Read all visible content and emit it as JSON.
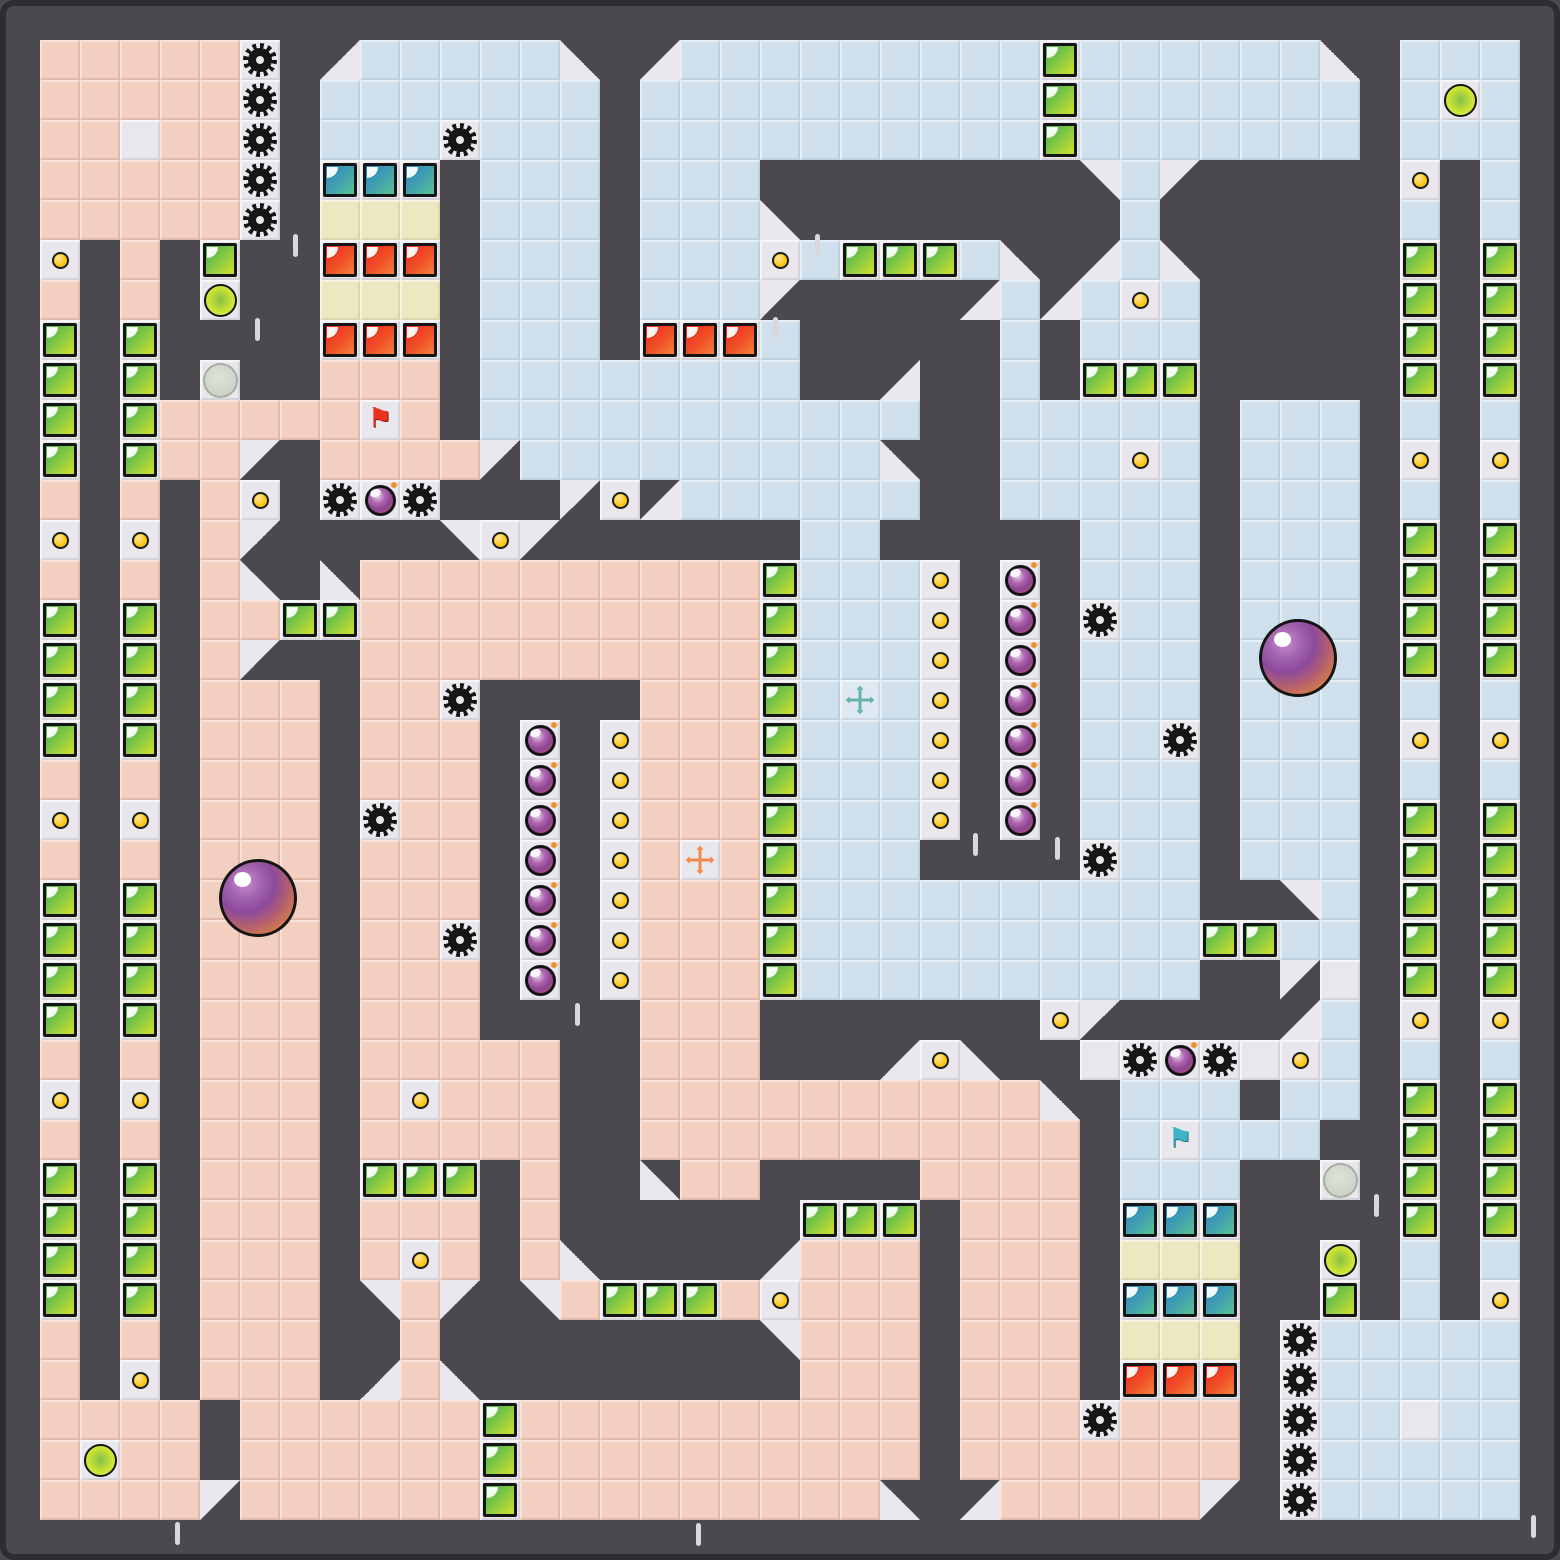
{
  "board": {
    "cols": 37,
    "rows": 37,
    "tile_px": 40,
    "offset_px": 40,
    "width_px": 1560,
    "height_px": 1560
  },
  "palette": {
    "wall": "#4b484e",
    "wall_edge": "#2e2c31",
    "floor_pink": "#f2cfc0",
    "floor_blue": "#cfe0ec",
    "tile_white": "#e9e7ec",
    "tile_cream": "#ece9c2",
    "box_green": [
      "#3fae4e",
      "#cfe22e"
    ],
    "box_red": [
      "#ee2020",
      "#f4823a"
    ],
    "box_cyan": [
      "#2b84c8",
      "#57c291"
    ],
    "coin": "#fcca1c",
    "gear": "#161616",
    "bomb": [
      "#b06ab4",
      "#8d4490"
    ],
    "goal_ball": [
      "#86bf4a",
      "#e4f163"
    ],
    "large_marble": [
      "#8d4a9c",
      "#ef9a43"
    ],
    "gray_marble": "#ccd3c5",
    "flag_red": "#e93220",
    "flag_teal": "#3fb4c8",
    "cross_orange": "#f08a4d",
    "cross_teal": "#63b3a9"
  },
  "legend": {
    ".": "wall",
    "p": "pink-floor",
    "b": "blue-floor",
    "W": "white-tile",
    "y": "cream-tile",
    "g": "green-box",
    "r": "red-box",
    "u": "cyan-box",
    "c": "coin",
    "G": "gear",
    "B": "bomb",
    "h": "goal-ball",
    "m": "gray-marble",
    "F": "red-flag",
    "f": "teal-flag",
    "X": "orange-move-cross",
    "x": "teal-move-cross",
    "1": "diag-dark-top-left",
    "2": "diag-dark-top-right",
    "3": "diag-dark-bottom-left",
    "4": "diag-dark-bottom-right"
  },
  "map": [
    "pppppG.1bbbbb2.1bbbbbbbbbgbbbbbb2.bbb",
    "pppppG.bbbbbbb.bbbbbbbbbbgbbbbbbb.bhb",
    "ppWppG.bbbGbbb.bbbbbbbbbbgbbbbbbb.bbb",
    "pppppG.uuu.bbb.bbb........3b4.....c.b",
    "pppppG.yyy.bbb.bbb2........b......b.b",
    "c.p.g..rrr.bbb.bbbcbgggb2.1b2.....g.g",
    "p.p.h..yyy.bbb.bbb4....1b1bcb.....g.g",
    "g.g....rrr.bbb.rrrb.....b.bbb.....g.g",
    "g.g.m..ppp.bbbbbbbb..1..b.ggg.....g.g",
    "g.gpppppFp.bbbbbbbbbbb..bbbbb.bbb.b.b",
    "g.gpp4.pppp4bbbbbbbbb2..bbbcb.bbb.c.c",
    "p.p.pc.GBG...4c1bbbbbb..bbbbb.bbb.b.b",
    "c.c.p4....3c4......bb.....bbb.bbb.g.g",
    "p.p.p2.2ppppppppppgbbbc.B.bbb.bbb.g.g",
    "g.g.ppggppppppppppgbbbc.B.Gbb.bbb.g.g",
    "g.g.p4..ppppppppppgbbbc.B.bbb.bbb.g.g",
    "g.g.ppp.ppG....pppgbxbc.B.bbb.bbb.b.b",
    "g.g.ppp.ppp.B.cpppgbbbc.B.bbG.bbb.c.c",
    "p.p.ppp.ppp.B.cpppgbbbc.B.bbb.bbb.b.b",
    "c.c.ppp.Gpp.B.cpppgbbbc.B.bbb.bbb.g.g",
    "p.p.ppp.ppp.B.cpXpgbbb....Gbb.bbb.g.g",
    "g.g.ppp.ppp.B.cpppgbbbbbbbbbb..3b.g.g",
    "g.g.ppp.ppG.B.cpppgbbbbbbbbbbggbb.g.g",
    "g.g.ppp.ppp.B.cpppgbbbbbbbbbb..4W.g.g",
    "g.g.ppp.ppp....ppp.......c4....1b.c.c",
    "p.p.ppp.ppppp..ppp...1c2..WGBGWcb.b.b",
    "c.c.ppp.pcppp..pppppppppp2.bbb.bb.g.g",
    "p.p.ppp.ppppp..ppppppppppp.bfbbb..g.g",
    "g.g.ppp.ggg.p..2pp....pppp.bbb..m.g.g",
    "g.g.ppp.ppp.p......ggg.ppp.uuu....g.g",
    "g.g.ppp.pcp.p2....1ppp.ppp.yyy..h.b.b",
    "g.g.ppp.3p4.3pgggpcppp.ppp.uuu..g.b.c",
    "p.p.ppp..p........3ppp.ppp.yyy.Gbbbbb",
    "p.c.ppp.1p2........ppp.ppp.rrr.Gbbbbb",
    "pppp.ppppppgpppppppppp.pppGppp.GbbWbb",
    "phpp.ppppppgpppppppppp.ppppppp.Gbbbbb",
    "pppp4ppppppgppppppppp2.1ppppp4.Gbbbbb"
  ],
  "entities": {
    "large_marbles": [
      {
        "cx": 258,
        "cy": 898,
        "r": 39
      },
      {
        "cx": 1298,
        "cy": 658,
        "r": 39
      }
    ],
    "wall_notches": [
      {
        "x": 295,
        "y": 245
      },
      {
        "x": 257,
        "y": 329
      },
      {
        "x": 775,
        "y": 328
      },
      {
        "x": 817,
        "y": 245
      },
      {
        "x": 577,
        "y": 1014
      },
      {
        "x": 975,
        "y": 844
      },
      {
        "x": 1057,
        "y": 848
      },
      {
        "x": 1376,
        "y": 1205
      },
      {
        "x": 1533,
        "y": 1526
      },
      {
        "x": 177,
        "y": 1533
      },
      {
        "x": 698,
        "y": 1534
      }
    ]
  },
  "glyphs": {
    "flag": "⚑"
  }
}
